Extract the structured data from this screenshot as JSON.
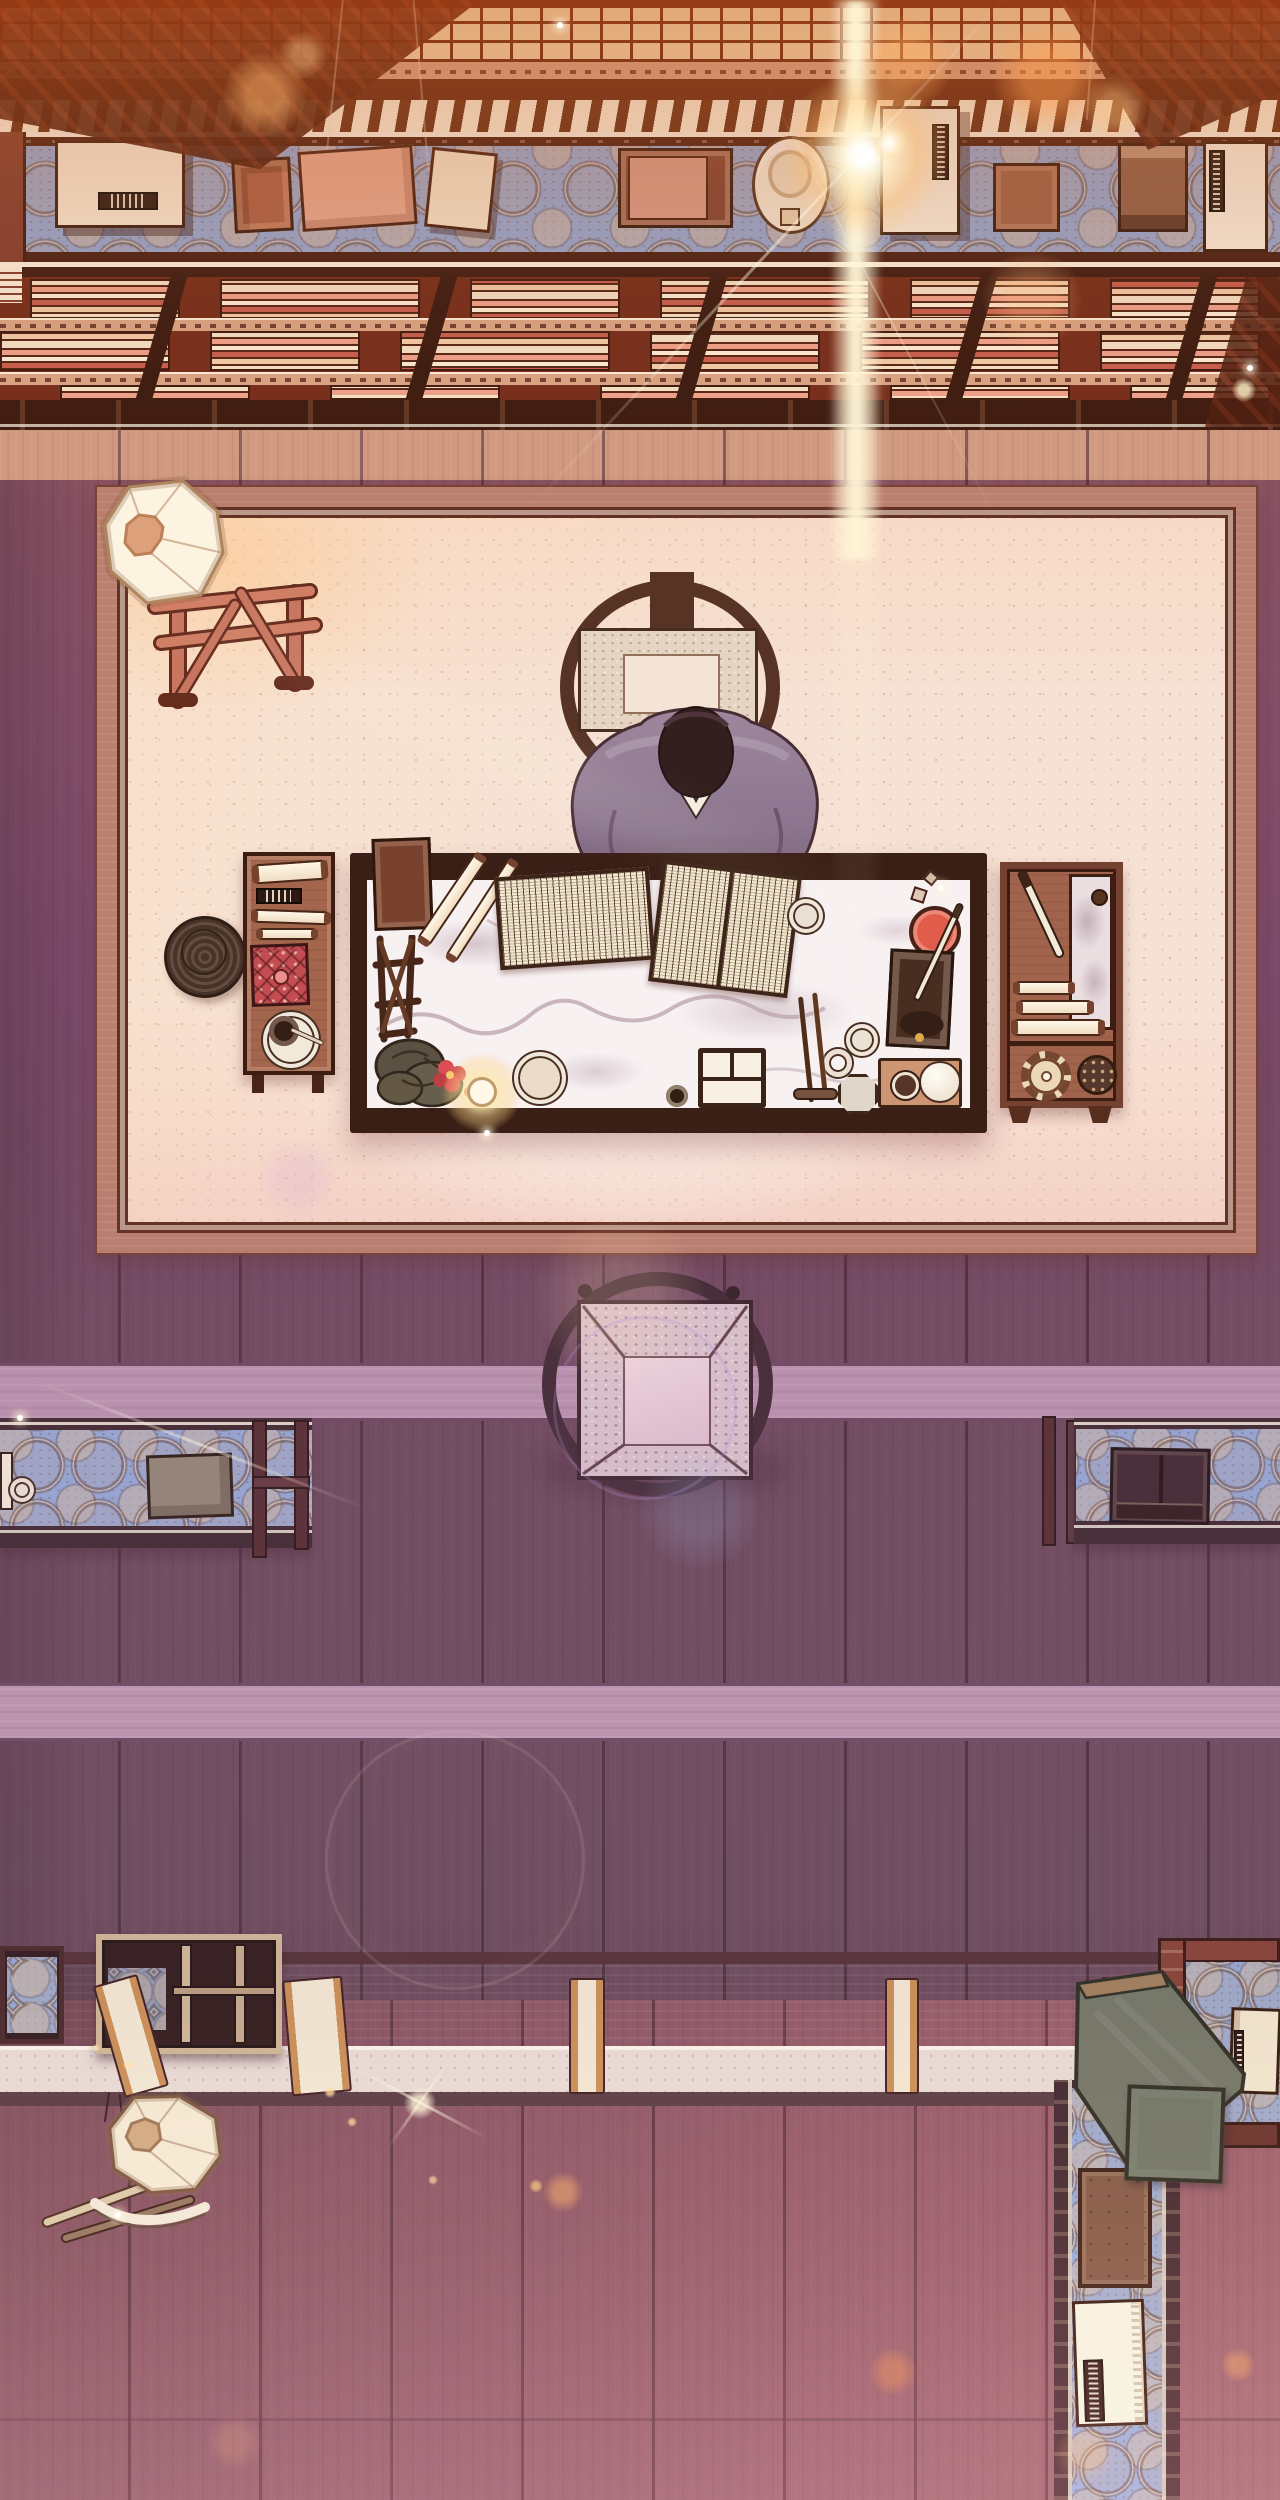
{
  "scene": {
    "title": "Scholar's Study - Top-Down Battle Map",
    "style": "hand-drawn manhwa interior, overhead view, warm lens-flare lighting",
    "view": "top-down",
    "size": {
      "width": 1280,
      "height": 2500
    }
  },
  "palette": {
    "clothBlue": "#8fa6d4",
    "floorUpper": "#cc937c",
    "floorMid": "#ab82a0",
    "floorLow": "#bd92a0",
    "rugBase": "#f5e1d4",
    "rugRim": "#b5796a",
    "marble": "#f7f0f2",
    "deskFrame": "#2a1510",
    "robe": "#8a7390",
    "hair": "#241519",
    "chairWood": "#4a2a20",
    "boardGreen": "#6a7263",
    "benchTop": "#9c8c92",
    "benchFace": "#e9dad4",
    "strapTan": "#c88b52",
    "strapCream": "#f4e7d2",
    "redBox": "#c04552",
    "lanternCream": "#fbf0de",
    "flareWhite": "#fff6e2"
  },
  "objects": [
    {
      "name": "bookshelf-wall",
      "desc": "lattice-topped shelf wall with rows of stacked books"
    },
    {
      "name": "display-table-top",
      "desc": "long table with blue medallion cloth holding boxes, books, a hat and labelled scrolls"
    },
    {
      "name": "floor-lamp",
      "desc": "octagonal paper lantern on wooden trestle stand, upper-left of rug"
    },
    {
      "name": "scholar",
      "desc": "robed figure seated at round-back chair, leaning over desk"
    },
    {
      "name": "writing-desk",
      "desc": "marble-top desk with open books, scrolls, ink stone, brushes, seal box, candle and plant"
    },
    {
      "name": "side-table-left",
      "desc": "small wooden table with scrolls, name plaque, red brocade box and tea plate"
    },
    {
      "name": "woven-basket",
      "desc": "dark coiled basket beside left side table"
    },
    {
      "name": "side-shelf-right",
      "desc": "wooden tray shelf with brush, marble slab, scroll rolls, gear wheel and patterned plate"
    },
    {
      "name": "guest-chair",
      "desc": "empty round-back chair with brocade seat, centre of room"
    },
    {
      "name": "long-table-left",
      "desc": "blue-cloth console table, left wall"
    },
    {
      "name": "long-table-right",
      "desc": "blue-cloth console table with dark cabinet, right wall"
    },
    {
      "name": "bench-ledge",
      "desc": "full-width stone-top bench with draped fabric straps"
    },
    {
      "name": "fallen-lantern",
      "desc": "octagonal lantern with poles below bench, lower-left"
    },
    {
      "name": "corner-tables-bottom-right",
      "desc": "L-shaped blue-cloth tables with green boards, crates and white book"
    }
  ],
  "effects": {
    "bokeh": [
      {
        "x": 265,
        "y": 95,
        "r": 42,
        "c": "#ffb36a",
        "o": 0.5
      },
      {
        "x": 303,
        "y": 55,
        "r": 24,
        "c": "#ffc98a",
        "o": 0.4
      },
      {
        "x": 905,
        "y": 62,
        "r": 48,
        "c": "#ffae5e",
        "o": 0.45
      },
      {
        "x": 1048,
        "y": 78,
        "r": 55,
        "c": "#ff9e4e",
        "o": 0.5
      },
      {
        "x": 1115,
        "y": 108,
        "r": 32,
        "c": "#ffc47e",
        "o": 0.4
      },
      {
        "x": 1032,
        "y": 300,
        "r": 50,
        "c": "#ffb87a",
        "o": 0.3
      },
      {
        "x": 1244,
        "y": 390,
        "r": 12,
        "c": "#fff1c8",
        "o": 0.8
      },
      {
        "x": 298,
        "y": 1178,
        "r": 40,
        "c": "#d9a8d8",
        "o": 0.22
      },
      {
        "x": 620,
        "y": 1300,
        "r": 85,
        "c": "#ffd9b0",
        "o": 0.18
      },
      {
        "x": 645,
        "y": 1408,
        "r": 92,
        "c": "#b890d8",
        "o": 0.25,
        "ring": true
      },
      {
        "x": 700,
        "y": 1510,
        "r": 60,
        "c": "#9fb8e8",
        "o": 0.18
      },
      {
        "x": 455,
        "y": 1860,
        "r": 130,
        "c": "#e8c4b8",
        "o": 0.15,
        "ring": true
      },
      {
        "x": 563,
        "y": 2192,
        "r": 20,
        "c": "#ffb36a",
        "o": 0.5
      },
      {
        "x": 420,
        "y": 2103,
        "r": 16,
        "c": "#fff3d8",
        "o": 0.8
      },
      {
        "x": 893,
        "y": 2372,
        "r": 24,
        "c": "#ff9e5e",
        "o": 0.4
      },
      {
        "x": 1238,
        "y": 2365,
        "r": 17,
        "c": "#ffae6e",
        "o": 0.45
      },
      {
        "x": 1085,
        "y": 2455,
        "r": 30,
        "c": "#ffc08a",
        "o": 0.25
      },
      {
        "x": 235,
        "y": 2442,
        "r": 28,
        "c": "#ffb88a",
        "o": 0.2
      },
      {
        "x": 330,
        "y": 2092,
        "r": 6,
        "c": "#ffd9a0",
        "o": 0.8
      },
      {
        "x": 352,
        "y": 2122,
        "r": 5,
        "c": "#ffcf90",
        "o": 0.8
      },
      {
        "x": 433,
        "y": 2180,
        "r": 5,
        "c": "#ffd9a0",
        "o": 0.7
      },
      {
        "x": 536,
        "y": 2186,
        "r": 7,
        "c": "#ffc980",
        "o": 0.7
      },
      {
        "x": 128,
        "y": 2065,
        "r": 5,
        "c": "#ffe0b0",
        "o": 0.9
      },
      {
        "x": 96,
        "y": 2048,
        "r": 4,
        "c": "#ffe0b0",
        "o": 0.8
      }
    ],
    "sparkles": [
      {
        "x": 487,
        "y": 1133
      },
      {
        "x": 941,
        "y": 888
      },
      {
        "x": 1250,
        "y": 368
      },
      {
        "x": 20,
        "y": 1418
      },
      {
        "x": 118,
        "y": 2215
      },
      {
        "x": 560,
        "y": 25
      }
    ],
    "streaks": [
      {
        "x": 770,
        "y": 250,
        "len": 700,
        "w": 3,
        "angle": -47,
        "o": 0.5
      },
      {
        "x": 880,
        "y": 300,
        "len": 500,
        "w": 2,
        "angle": 62,
        "o": 0.35
      },
      {
        "x": 200,
        "y": 1444,
        "len": 360,
        "w": 3,
        "angle": 21,
        "o": 0.5
      },
      {
        "x": 420,
        "y": 2102,
        "len": 150,
        "w": 3,
        "angle": 28,
        "o": 0.7
      },
      {
        "x": 420,
        "y": 2102,
        "len": 110,
        "w": 3,
        "angle": -55,
        "o": 0.6
      },
      {
        "x": 520,
        "y": 760,
        "len": 900,
        "w": 60,
        "angle": 24,
        "o": 0.1
      }
    ]
  },
  "bench": {
    "straps": [
      {
        "x": 108,
        "w": 46,
        "tilt": -16
      },
      {
        "x": 287,
        "w": 60,
        "tilt": -5
      },
      {
        "x": 569,
        "w": 36,
        "tilt": 0
      },
      {
        "x": 885,
        "w": 34,
        "tilt": 0
      },
      {
        "x": 1098,
        "w": 38,
        "tilt": 3
      },
      {
        "x": 1191,
        "w": 38,
        "tilt": 4
      }
    ]
  }
}
